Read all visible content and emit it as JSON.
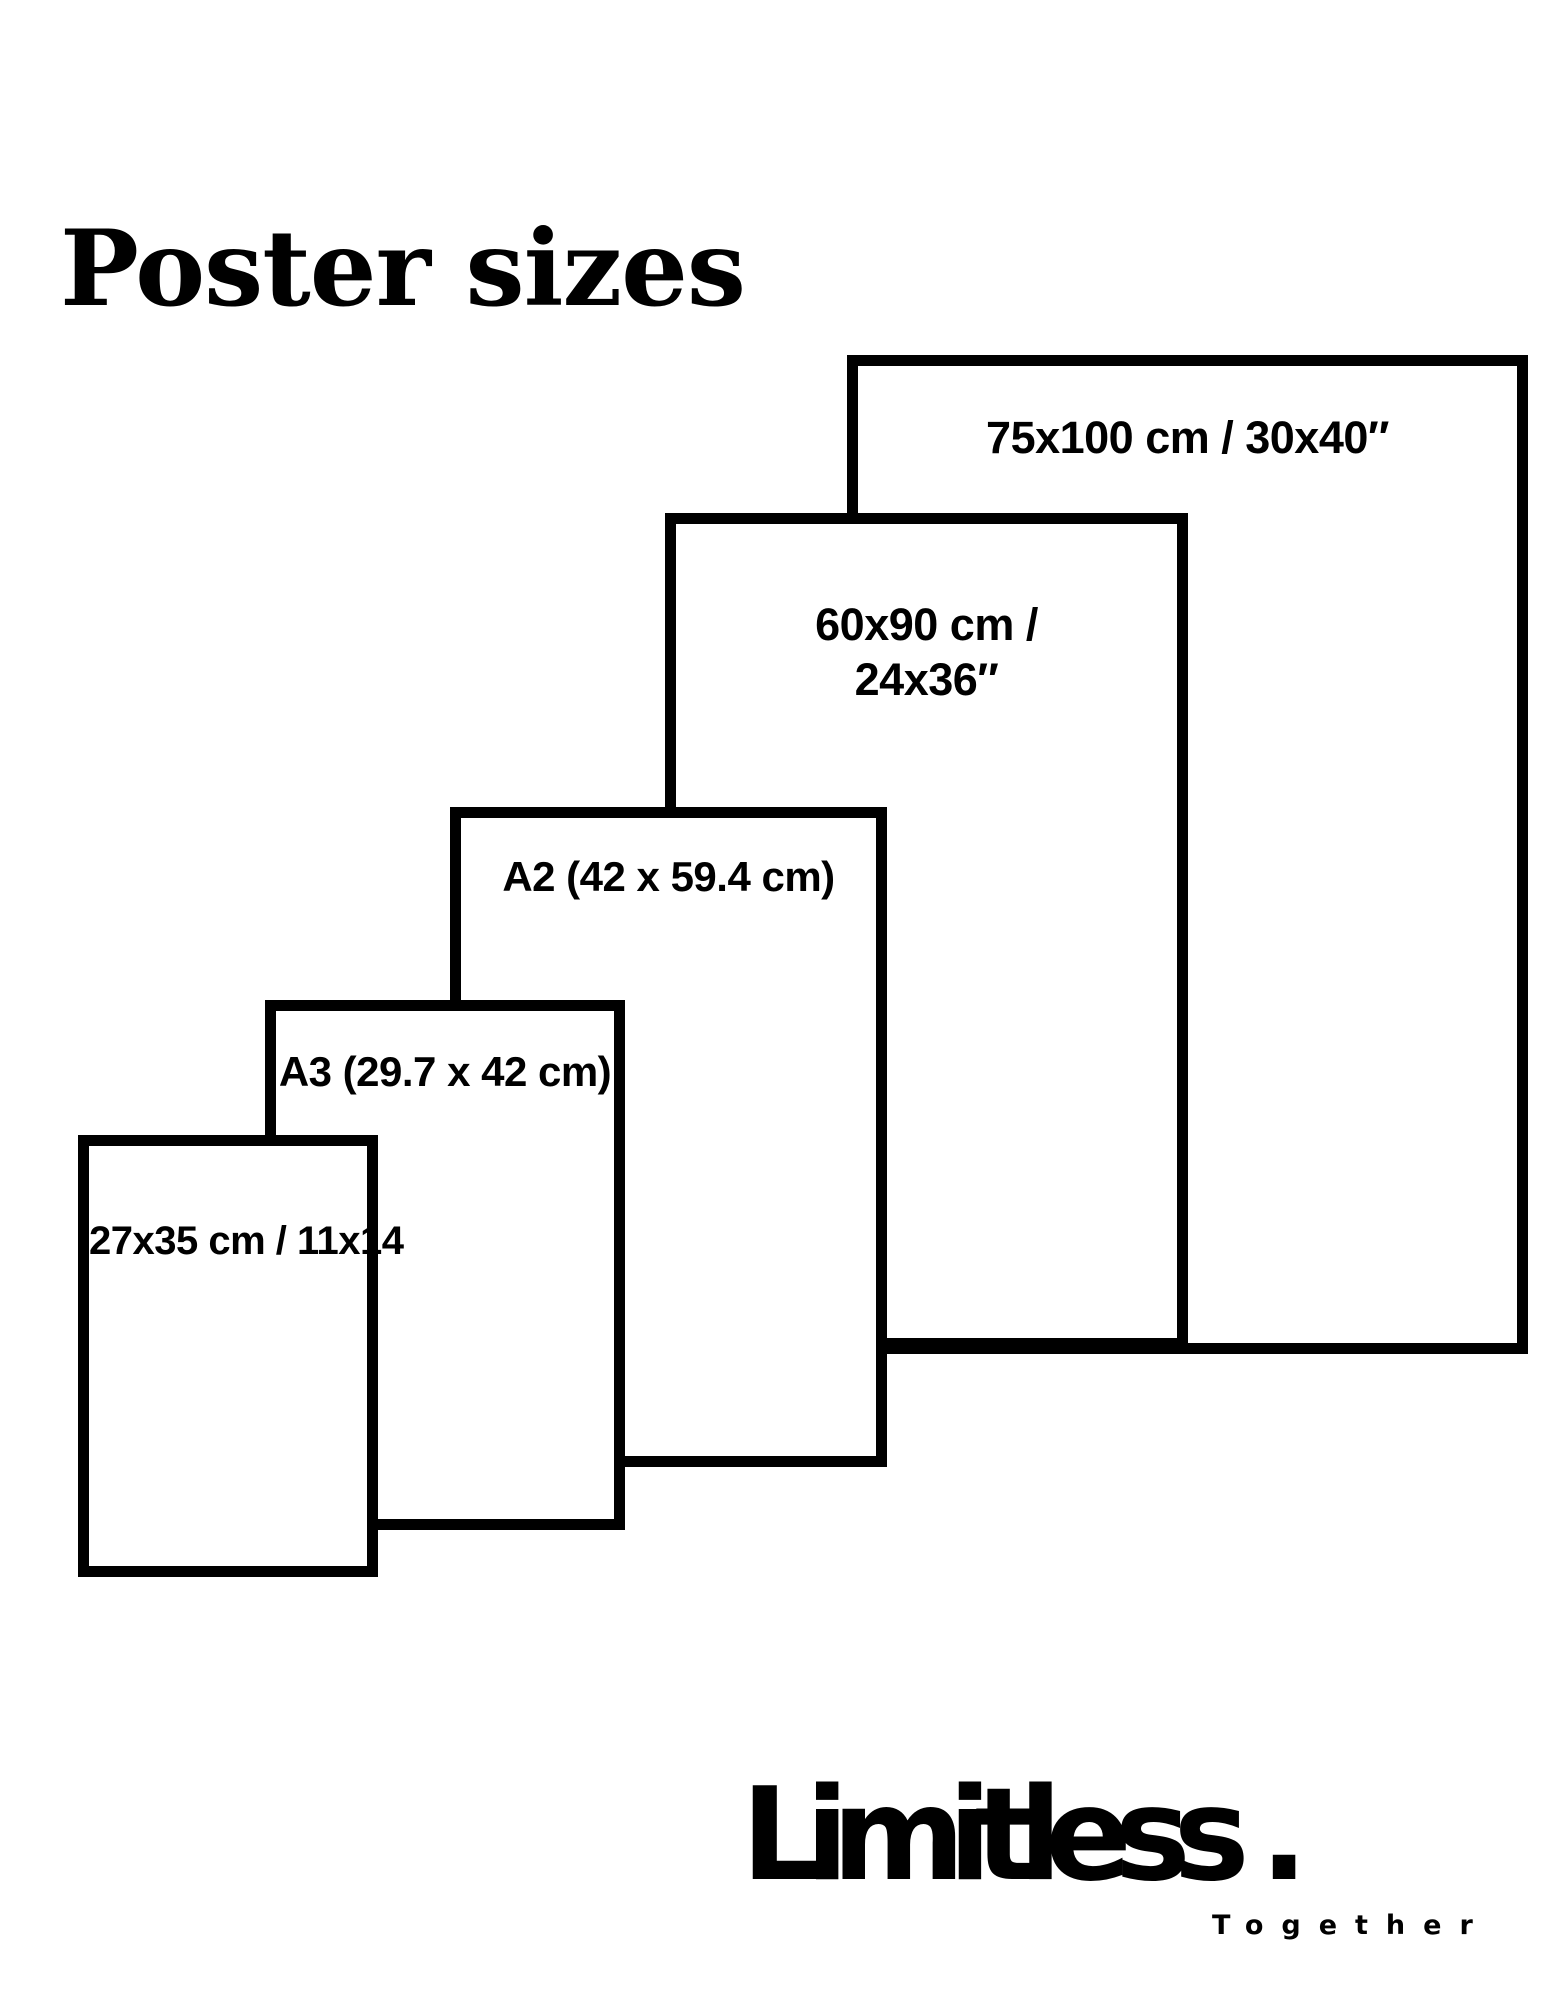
{
  "title": "Poster sizes",
  "sizes": [
    {
      "name": "75x100",
      "label": "75x100 cm / 30x40″"
    },
    {
      "name": "60x90",
      "label": "60x90 cm / 24x36″"
    },
    {
      "name": "A2",
      "label": "A2 (42 x 59.4 cm)"
    },
    {
      "name": "A3",
      "label": "A3 (29.7 x 42 cm)"
    },
    {
      "name": "27x35",
      "label": "27x35 cm / 11x14"
    }
  ],
  "logo": {
    "wordmark": "Limitless .",
    "tagline": "Together"
  },
  "colors": {
    "ink": "#000000",
    "background": "#ffffff"
  }
}
